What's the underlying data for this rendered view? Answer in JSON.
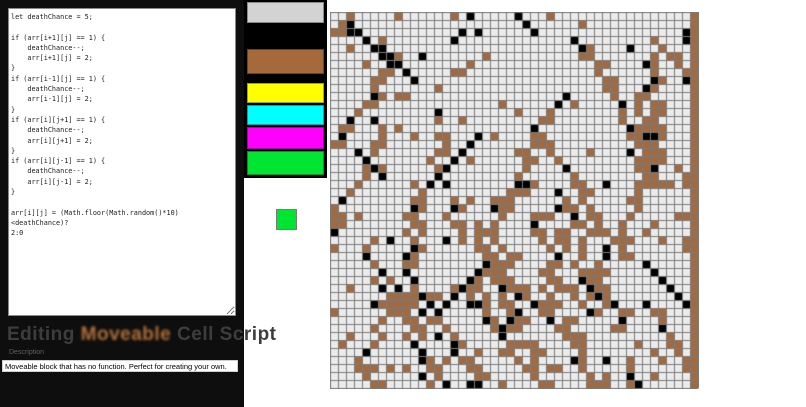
{
  "editor": {
    "code": "let deathChance = 5;\n\nif (arr[i+1][j] == 1) {\n    deathChance--;\n    arr[i+1][j] = 2;\n}\nif (arr[i-1][j] == 1) {\n    deathChance--;\n    arr[i-1][j] = 2;\n}\nif (arr[i][j+1] == 1) {\n    deathChance--;\n    arr[i][j+1] = 2;\n}\nif (arr[i][j-1] == 1) {\n    deathChance--;\n    arr[i][j-1] = 2;\n}\n\narr[i][j] = (Math.floor(Math.random()*10)<deathChance)?\n2:0"
  },
  "heading": {
    "prefix": "Editing ",
    "highlight": "Moveable",
    "suffix": " Cell Script",
    "highlight_color": "#b4713a"
  },
  "description": {
    "label": "Description",
    "value": "Moveable block that has no function. Perfect for creating your own."
  },
  "palette": {
    "swatches": [
      {
        "name": "lightgray",
        "color": "#d3d3d3"
      },
      {
        "name": "black",
        "color": "#000000"
      },
      {
        "name": "brown",
        "color": "#a5693b"
      },
      {
        "name": "yellow",
        "color": "#ffff00"
      },
      {
        "name": "cyan",
        "color": "#00ffff"
      },
      {
        "name": "magenta",
        "color": "#ff00ff"
      },
      {
        "name": "green",
        "color": "#00e532"
      }
    ],
    "selected_color": "#00e532"
  },
  "grid": {
    "cols": 46,
    "rows": 47,
    "cell_px": 8,
    "colors": {
      "empty": "#ebebeb",
      "brown": "#a5693b",
      "black": "#000000",
      "line": "#7a7a7a"
    },
    "seed": 1337,
    "streak_count": 34,
    "black_run_count": 11,
    "sprinkle_brown": 0.045,
    "sprinkle_black": 0.012,
    "right_column_color": "brown"
  }
}
